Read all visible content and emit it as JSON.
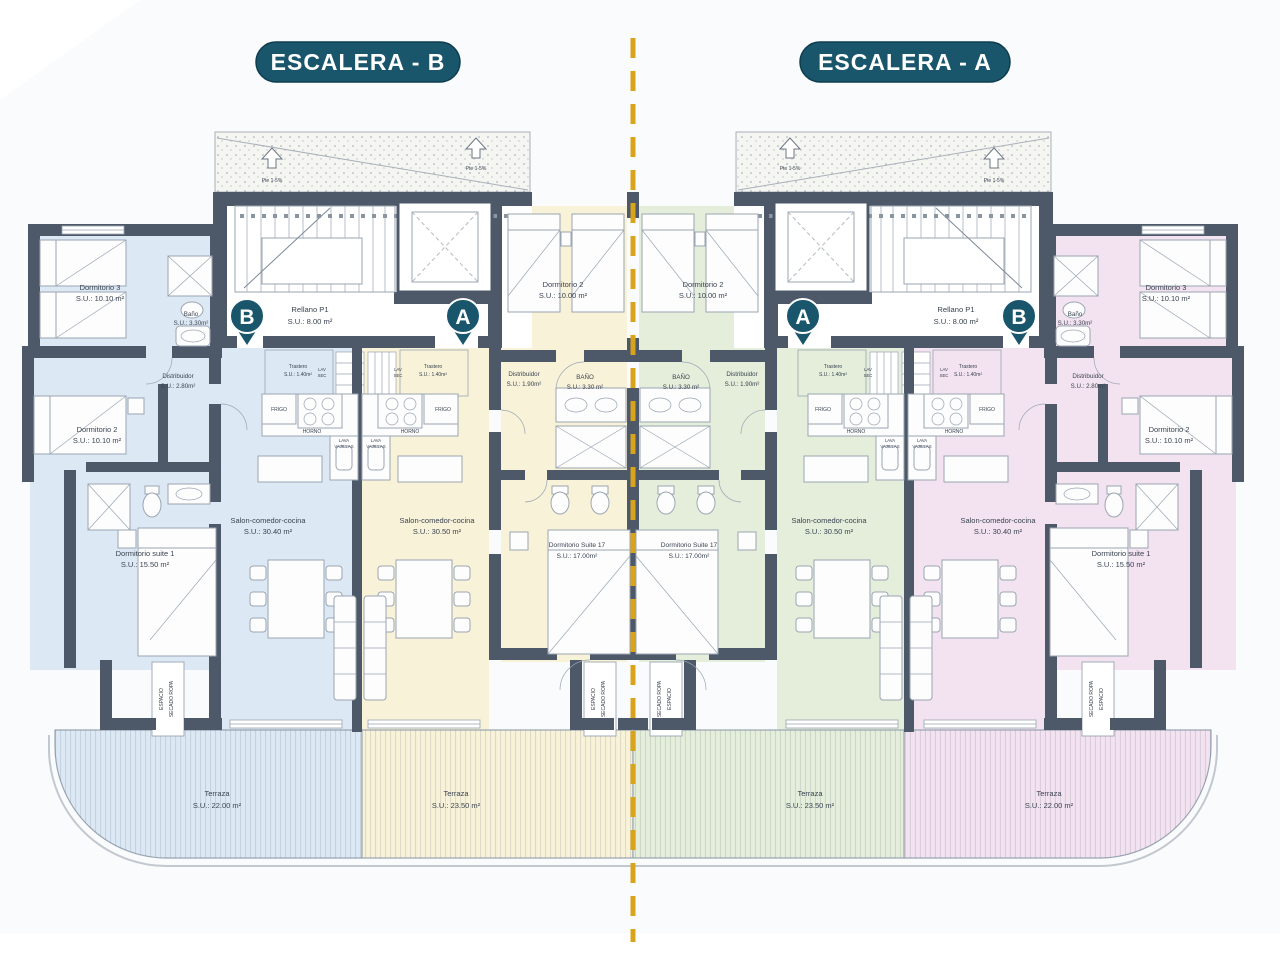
{
  "colors": {
    "teal": "#19566b",
    "gold": "#d9a41b",
    "wall": "#4d5968",
    "blue": "#dce9f5",
    "cream": "#f8f2d8",
    "green": "#e4eedb",
    "pink": "#f3e2f0",
    "ink": "#3a4350",
    "line": "#9aa5b2"
  },
  "titles": {
    "left": "ESCALERA - B",
    "right": "ESCALERA - A"
  },
  "badges": {
    "outer": "B",
    "inner": "A"
  },
  "core": {
    "rellano_name": "Rellano P1",
    "rellano_area": "S.U.: 8.00 m²",
    "slope": "Pte 1-5%"
  },
  "rooms": {
    "outer": {
      "dorm3": {
        "name": "Dormitorio 3",
        "area": "S.U.: 10.10 m²"
      },
      "bano": {
        "name": "Baño",
        "area": "S.U.: 3.30m²"
      },
      "distribuidor": {
        "name": "Distribuidor",
        "area": "S.U.: 2.80m²"
      },
      "dorm2": {
        "name": "Dormitorio 2",
        "area": "S.U.: 10.10 m²"
      },
      "suite1": {
        "name": "Dormitorio suite 1",
        "area": "S.U.: 15.50 m²"
      },
      "salon": {
        "name": "Salon-comedor-cocina",
        "area": "S.U.: 30.40 m²"
      },
      "terraza": {
        "name": "Terraza",
        "area": "S.U.: 22.00 m²"
      },
      "trastero": {
        "name": "Trastero",
        "area": "S.U.: 1.40m²"
      }
    },
    "inner": {
      "dorm2": {
        "name": "Dormitorio 2",
        "area": "S.U.: 10.00 m²"
      },
      "distribuidor": {
        "name": "Distribuidor",
        "area": "S.U.: 1.90m²"
      },
      "bano": {
        "name": "BAÑO",
        "area": "S.U.: 3.30 m²"
      },
      "suite": {
        "name": "Dormitorio Suite 17",
        "area": "S.U.: 17.00m²"
      },
      "salon": {
        "name": "Salon-comedor-cocina",
        "area": "S.U.: 30.50 m²"
      },
      "terraza": {
        "name": "Terraza",
        "area": "S.U.: 23.50 m²"
      },
      "trastero": {
        "name": "Trastero",
        "area": "S.U.: 1.40m²"
      }
    }
  },
  "fixtures": {
    "frigo": "FRIGO",
    "horno": "HORNO",
    "lava1": "LAVA",
    "lava2": "VAJILLAS",
    "lav": "LAV",
    "sec": "SEC",
    "drying1": "ESPACIO",
    "drying2": "SECADO ROPA"
  }
}
